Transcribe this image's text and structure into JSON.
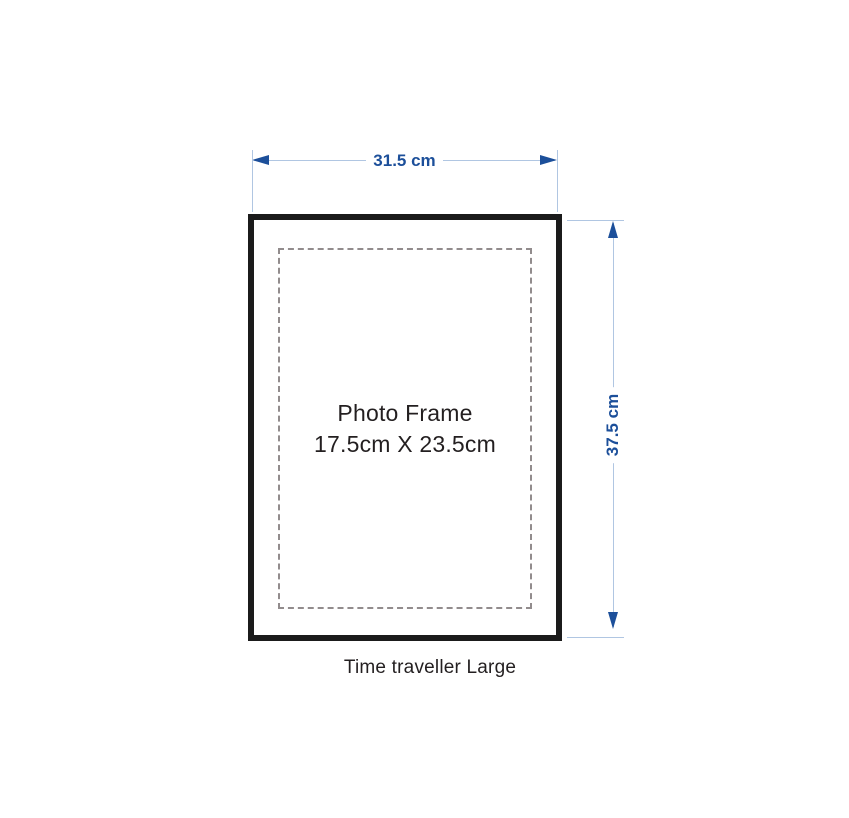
{
  "diagram": {
    "title_caption": "Time traveller Large",
    "frame": {
      "label_line1": "Photo Frame",
      "label_line2": "17.5cm X 23.5cm"
    },
    "dimensions": {
      "width_label": "31.5 cm",
      "height_label": "37.5 cm"
    },
    "colors": {
      "dimension_text_blue": "#1c4f9a",
      "dimension_line_blue": "#b0c6e2",
      "frame_border_black": "#1b1b1b",
      "mat_dashed_gray": "#928c8d",
      "label_text_dark": "#231f20",
      "background": "#ffffff"
    },
    "icons": {
      "left_arrowhead": "arrow-left-icon",
      "right_arrowhead": "arrow-right-icon",
      "up_arrowhead": "arrow-up-icon",
      "down_arrowhead": "arrow-down-icon"
    }
  }
}
